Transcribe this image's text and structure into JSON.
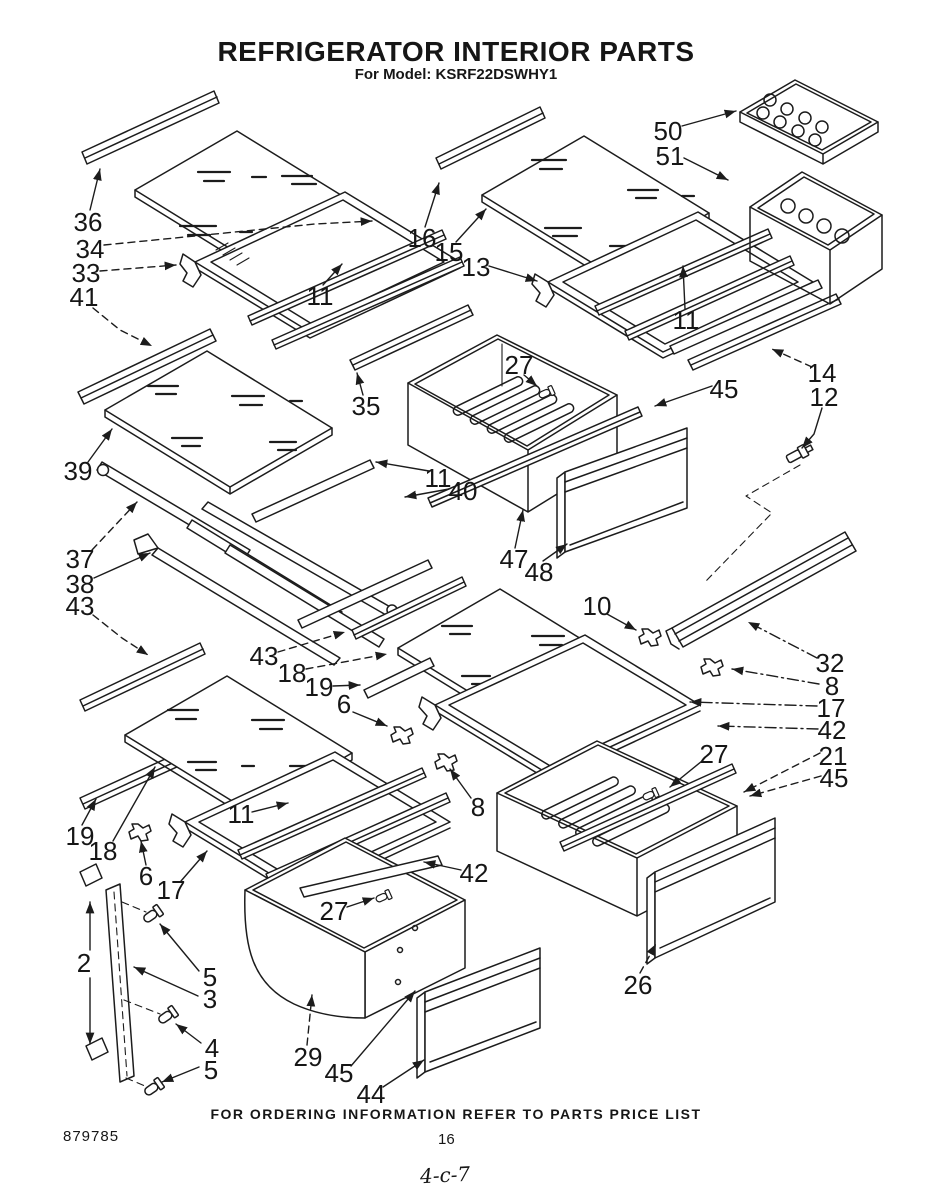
{
  "page": {
    "title": "REFRIGERATOR INTERIOR PARTS",
    "subtitle": "For Model: KSRF22DSWHY1",
    "footer_note": "FOR ORDERING INFORMATION REFER TO PARTS PRICE LIST",
    "doc_number": "879785",
    "page_number": "16",
    "handwritten_mark": "4-c-7"
  },
  "diagram": {
    "kind": "exploded-parts-diagram",
    "background_color": "#ffffff",
    "ink_color": "#1c1c1c",
    "part_numbers_visible": [
      "2",
      "3",
      "4",
      "5",
      "6",
      "8",
      "10",
      "11",
      "12",
      "13",
      "14",
      "15",
      "16",
      "17",
      "18",
      "19",
      "21",
      "26",
      "27",
      "29",
      "32",
      "33",
      "34",
      "35",
      "36",
      "37",
      "38",
      "39",
      "40",
      "41",
      "42",
      "43",
      "44",
      "45",
      "47",
      "48",
      "50",
      "51"
    ],
    "callouts": [
      {
        "t": "36",
        "x": 88,
        "y": 222,
        "leads": [
          {
            "pts": [
              [
                90,
                210
              ],
              [
                100,
                169
              ]
            ]
          }
        ]
      },
      {
        "t": "34",
        "x": 90,
        "y": 249,
        "leads": [
          {
            "pts": [
              [
                104,
                245
              ],
              [
                205,
                235
              ],
              [
                315,
                224
              ],
              [
                372,
                221
              ]
            ],
            "style": "dash"
          }
        ]
      },
      {
        "t": "33",
        "x": 86,
        "y": 273,
        "leads": [
          {
            "pts": [
              [
                100,
                271
              ],
              [
                176,
                265
              ]
            ],
            "style": "dash"
          }
        ]
      },
      {
        "t": "41",
        "x": 84,
        "y": 297,
        "leads": [
          {
            "pts": [
              [
                93,
                308
              ],
              [
                120,
                330
              ],
              [
                152,
                346
              ]
            ],
            "style": "dash"
          }
        ]
      },
      {
        "t": "16",
        "x": 422,
        "y": 238,
        "leads": [
          {
            "pts": [
              [
                425,
                227
              ],
              [
                439,
                183
              ]
            ]
          }
        ]
      },
      {
        "t": "15",
        "x": 449,
        "y": 252,
        "leads": [
          {
            "pts": [
              [
                456,
                242
              ],
              [
                486,
                209
              ]
            ]
          }
        ]
      },
      {
        "t": "13",
        "x": 476,
        "y": 267,
        "leads": [
          {
            "pts": [
              [
                489,
                266
              ],
              [
                537,
                281
              ]
            ]
          }
        ]
      },
      {
        "t": "11",
        "x": 320,
        "y": 296,
        "leads": [
          {
            "pts": [
              [
                323,
                285
              ],
              [
                342,
                264
              ]
            ]
          }
        ]
      },
      {
        "t": "50",
        "x": 668,
        "y": 131,
        "leads": [
          {
            "pts": [
              [
                682,
                126
              ],
              [
                736,
                111
              ]
            ]
          }
        ]
      },
      {
        "t": "51",
        "x": 670,
        "y": 156,
        "leads": [
          {
            "pts": [
              [
                684,
                158
              ],
              [
                728,
                180
              ]
            ]
          }
        ]
      },
      {
        "t": "11",
        "x": 686,
        "y": 320,
        "leads": [
          {
            "pts": [
              [
                685,
                309
              ],
              [
                683,
                266
              ]
            ]
          }
        ]
      },
      {
        "t": "14",
        "x": 822,
        "y": 373,
        "leads": [
          {
            "pts": [
              [
                812,
                367
              ],
              [
                772,
                349
              ]
            ],
            "style": "dash"
          }
        ]
      },
      {
        "t": "12",
        "x": 824,
        "y": 397,
        "leads": [
          {
            "pts": [
              [
                822,
                408
              ],
              [
                814,
                434
              ],
              [
                802,
                448
              ]
            ]
          }
        ]
      },
      {
        "t": "45",
        "x": 724,
        "y": 389,
        "leads": [
          {
            "pts": [
              [
                712,
                386
              ],
              [
                655,
                406
              ]
            ]
          }
        ]
      },
      {
        "t": "27",
        "x": 519,
        "y": 365,
        "leads": [
          {
            "pts": [
              [
                524,
                375
              ],
              [
                537,
                386
              ]
            ]
          }
        ]
      },
      {
        "t": "35",
        "x": 366,
        "y": 406,
        "leads": [
          {
            "pts": [
              [
                363,
                395
              ],
              [
                357,
                373
              ]
            ]
          }
        ]
      },
      {
        "t": "39",
        "x": 78,
        "y": 471,
        "leads": [
          {
            "pts": [
              [
                88,
                462
              ],
              [
                112,
                429
              ]
            ]
          }
        ]
      },
      {
        "t": "37",
        "x": 80,
        "y": 559,
        "leads": [
          {
            "pts": [
              [
                92,
                550
              ],
              [
                137,
                502
              ]
            ],
            "style": "dash"
          }
        ]
      },
      {
        "t": "38",
        "x": 80,
        "y": 584,
        "leads": [
          {
            "pts": [
              [
                94,
                578
              ],
              [
                150,
                553
              ]
            ]
          }
        ]
      },
      {
        "t": "43",
        "x": 80,
        "y": 606,
        "leads": [
          {
            "pts": [
              [
                93,
                615
              ],
              [
                122,
                638
              ],
              [
                148,
                655
              ]
            ],
            "style": "dash"
          }
        ]
      },
      {
        "t": "11",
        "x": 438,
        "y": 478,
        "leads": [
          {
            "pts": [
              [
                429,
                471
              ],
              [
                376,
                462
              ]
            ]
          }
        ]
      },
      {
        "t": "40",
        "x": 463,
        "y": 491,
        "leads": [
          {
            "pts": [
              [
                449,
                489
              ],
              [
                405,
                497
              ]
            ]
          }
        ]
      },
      {
        "t": "47",
        "x": 514,
        "y": 559,
        "leads": [
          {
            "pts": [
              [
                515,
                548
              ],
              [
                523,
                510
              ]
            ]
          }
        ]
      },
      {
        "t": "48",
        "x": 539,
        "y": 572,
        "leads": [
          {
            "pts": [
              [
                543,
                561
              ],
              [
                567,
                544
              ]
            ]
          }
        ]
      },
      {
        "t": "43",
        "x": 264,
        "y": 656,
        "leads": [
          {
            "pts": [
              [
                278,
                652
              ],
              [
                345,
                632
              ]
            ],
            "style": "dash"
          }
        ]
      },
      {
        "t": "18",
        "x": 292,
        "y": 673,
        "leads": [
          {
            "pts": [
              [
                306,
                669
              ],
              [
                387,
                654
              ]
            ],
            "style": "dash"
          }
        ]
      },
      {
        "t": "19",
        "x": 319,
        "y": 687,
        "leads": [
          {
            "pts": [
              [
                333,
                686
              ],
              [
                360,
                685
              ]
            ]
          }
        ]
      },
      {
        "t": "6",
        "x": 344,
        "y": 704,
        "leads": [
          {
            "pts": [
              [
                353,
                712
              ],
              [
                387,
                726
              ]
            ]
          }
        ]
      },
      {
        "t": "10",
        "x": 597,
        "y": 606,
        "leads": [
          {
            "pts": [
              [
                607,
                614
              ],
              [
                636,
                630
              ]
            ]
          }
        ]
      },
      {
        "t": "32",
        "x": 830,
        "y": 663,
        "leads": [
          {
            "pts": [
              [
                817,
                658
              ],
              [
                748,
                622
              ]
            ],
            "style": "dashdot"
          }
        ]
      },
      {
        "t": "8",
        "x": 832,
        "y": 686,
        "leads": [
          {
            "pts": [
              [
                819,
                684
              ],
              [
                732,
                669
              ]
            ],
            "style": "dashdot"
          }
        ]
      },
      {
        "t": "17",
        "x": 831,
        "y": 708,
        "leads": [
          {
            "pts": [
              [
                817,
                706
              ],
              [
                690,
                702
              ]
            ],
            "style": "dashdot"
          }
        ]
      },
      {
        "t": "42",
        "x": 832,
        "y": 730,
        "leads": [
          {
            "pts": [
              [
                818,
                729
              ],
              [
                718,
                726
              ]
            ],
            "style": "dashdot"
          }
        ]
      },
      {
        "t": "21",
        "x": 833,
        "y": 756,
        "leads": [
          {
            "pts": [
              [
                820,
                753
              ],
              [
                744,
                792
              ]
            ],
            "style": "dash"
          }
        ]
      },
      {
        "t": "45",
        "x": 834,
        "y": 778,
        "leads": [
          {
            "pts": [
              [
                821,
                776
              ],
              [
                750,
                796
              ]
            ],
            "style": "dash"
          }
        ]
      },
      {
        "t": "27",
        "x": 714,
        "y": 754,
        "leads": [
          {
            "pts": [
              [
                702,
                761
              ],
              [
                670,
                787
              ]
            ]
          }
        ]
      },
      {
        "t": "19",
        "x": 80,
        "y": 836,
        "leads": [
          {
            "pts": [
              [
                82,
                825
              ],
              [
                96,
                799
              ]
            ]
          }
        ]
      },
      {
        "t": "18",
        "x": 103,
        "y": 851,
        "leads": [
          {
            "pts": [
              [
                113,
                841
              ],
              [
                155,
                767
              ]
            ]
          }
        ]
      },
      {
        "t": "6",
        "x": 146,
        "y": 876,
        "leads": [
          {
            "pts": [
              [
                146,
                865
              ],
              [
                141,
                841
              ]
            ]
          }
        ]
      },
      {
        "t": "17",
        "x": 171,
        "y": 890,
        "leads": [
          {
            "pts": [
              [
                181,
                881
              ],
              [
                207,
                851
              ]
            ]
          }
        ]
      },
      {
        "t": "11",
        "x": 241,
        "y": 814,
        "leads": [
          {
            "pts": [
              [
                252,
                812
              ],
              [
                288,
                803
              ]
            ]
          }
        ]
      },
      {
        "t": "8",
        "x": 478,
        "y": 807,
        "leads": [
          {
            "pts": [
              [
                471,
                798
              ],
              [
                450,
                769
              ]
            ]
          }
        ]
      },
      {
        "t": "2",
        "x": 84,
        "y": 963,
        "leads": [
          {
            "pts": [
              [
                90,
                950
              ],
              [
                90,
                902
              ]
            ]
          },
          {
            "pts": [
              [
                90,
                978
              ],
              [
                90,
                1044
              ]
            ]
          }
        ]
      },
      {
        "t": "5",
        "x": 210,
        "y": 977,
        "leads": [
          {
            "pts": [
              [
                199,
                971
              ],
              [
                160,
                924
              ]
            ]
          }
        ]
      },
      {
        "t": "3",
        "x": 210,
        "y": 999,
        "leads": [
          {
            "pts": [
              [
                198,
                996
              ],
              [
                134,
                967
              ]
            ]
          }
        ]
      },
      {
        "t": "4",
        "x": 212,
        "y": 1048,
        "leads": [
          {
            "pts": [
              [
                201,
                1043
              ],
              [
                176,
                1024
              ]
            ]
          }
        ]
      },
      {
        "t": "5",
        "x": 211,
        "y": 1070,
        "leads": [
          {
            "pts": [
              [
                199,
                1067
              ],
              [
                162,
                1082
              ]
            ]
          }
        ]
      },
      {
        "t": "42",
        "x": 474,
        "y": 873,
        "leads": [
          {
            "pts": [
              [
                461,
                870
              ],
              [
                424,
                862
              ]
            ]
          }
        ]
      },
      {
        "t": "27",
        "x": 334,
        "y": 911,
        "leads": [
          {
            "pts": [
              [
                347,
                907
              ],
              [
                374,
                898
              ]
            ]
          }
        ]
      },
      {
        "t": "29",
        "x": 308,
        "y": 1057,
        "leads": [
          {
            "pts": [
              [
                307,
                1045
              ],
              [
                312,
                995
              ]
            ],
            "style": "dash"
          }
        ]
      },
      {
        "t": "45",
        "x": 339,
        "y": 1073,
        "leads": [
          {
            "pts": [
              [
                351,
                1066
              ],
              [
                415,
                991
              ]
            ]
          }
        ]
      },
      {
        "t": "44",
        "x": 371,
        "y": 1094,
        "leads": [
          {
            "pts": [
              [
                383,
                1087
              ],
              [
                424,
                1060
              ]
            ]
          }
        ]
      },
      {
        "t": "26",
        "x": 638,
        "y": 985,
        "leads": [
          {
            "pts": [
              [
                640,
                973
              ],
              [
                656,
                944
              ]
            ],
            "style": "dash"
          }
        ]
      }
    ]
  }
}
